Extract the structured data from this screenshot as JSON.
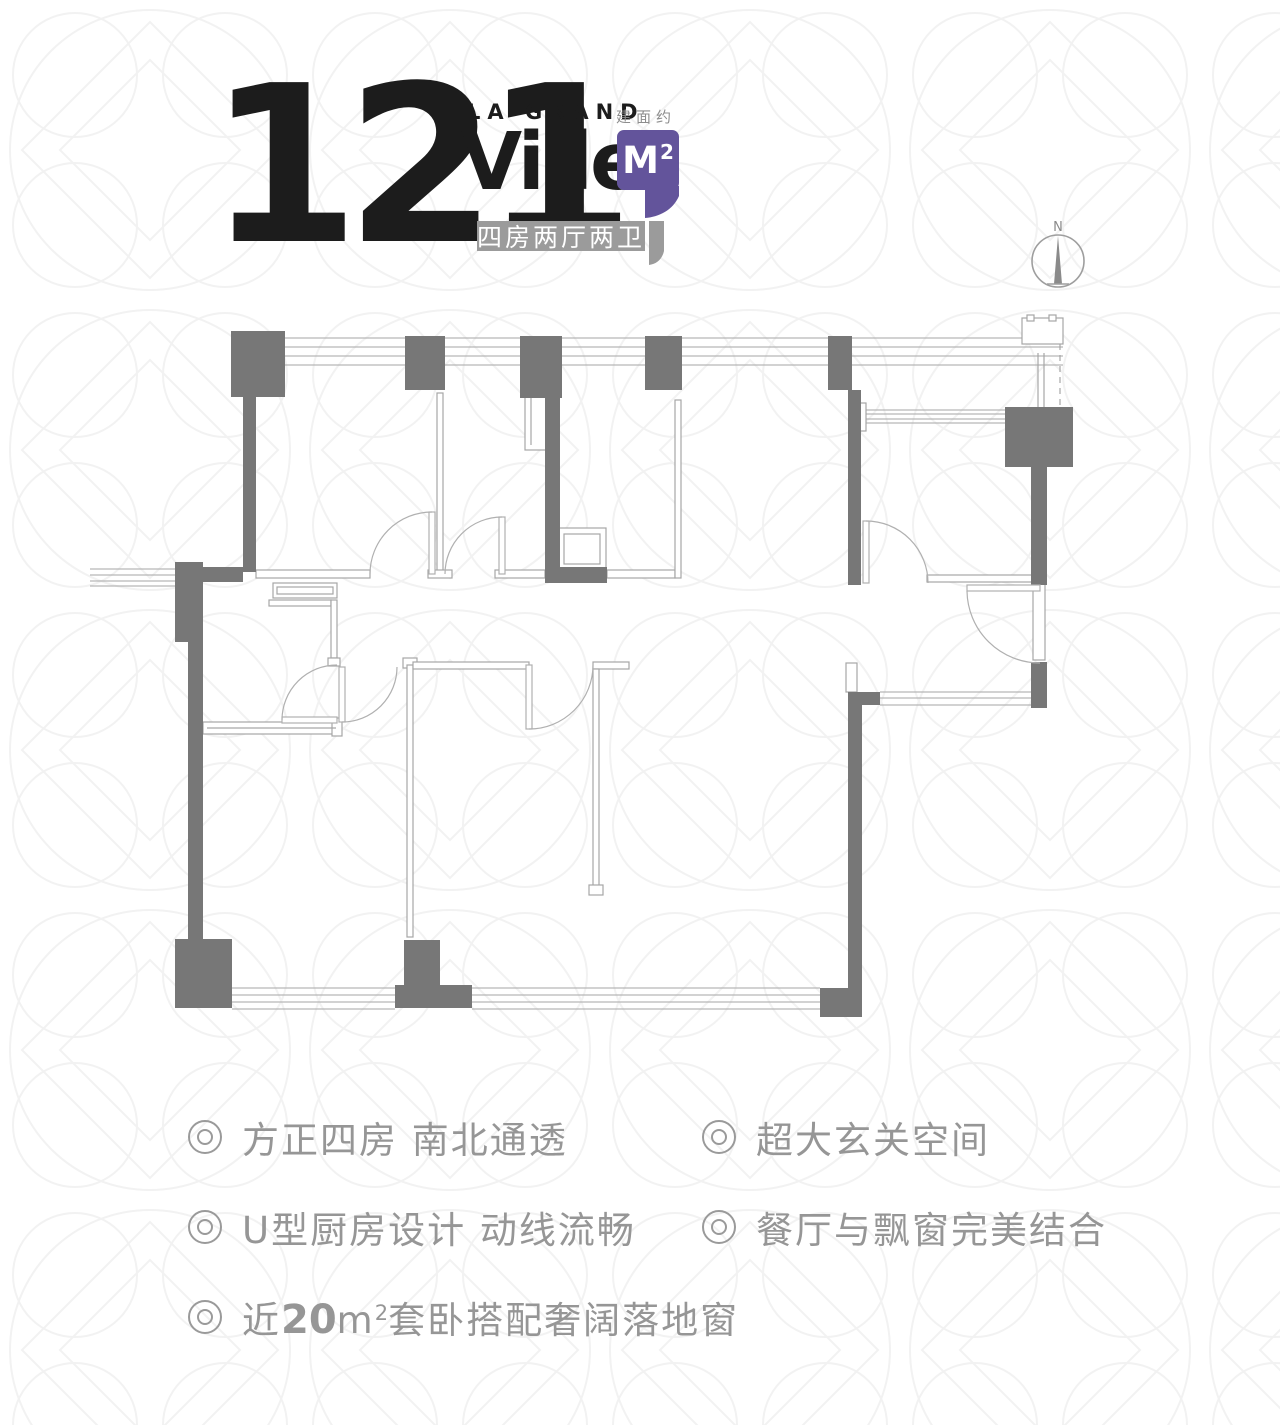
{
  "page": {
    "background": "#ffffff",
    "pattern_color": "#f2f2f2"
  },
  "header": {
    "area_number": "121",
    "brand_top": "LA GRAND",
    "brand_main": "Ville",
    "unit_label": "建面约",
    "unit_letter": "M",
    "unit_sup": "2",
    "layout_badge": "四房两厅两卫",
    "colors": {
      "purple": "#63549b",
      "badge_gray": "#9b9b9b",
      "headline_black": "#1c1c1c"
    }
  },
  "compass": {
    "north_label": "N"
  },
  "floorplan": {
    "type": "2d-apartment-floor-plan",
    "wall_fill": "#777777",
    "wall_line_color": "#a6a6a6",
    "window_line_color": "#b6b6b6",
    "door_arc_color": "#b0b0b0"
  },
  "features": {
    "text_color": "#969696",
    "f1": "方正四房 南北通透",
    "f2": "超大玄关空间",
    "f3": "U型厨房设计 动线流畅",
    "f4": "餐厅与飘窗完美结合",
    "f5": {
      "prefix": "近",
      "number": "20",
      "unit": "m",
      "unit_sup": "2",
      "suffix": "套卧搭配奢阔落地窗"
    }
  }
}
